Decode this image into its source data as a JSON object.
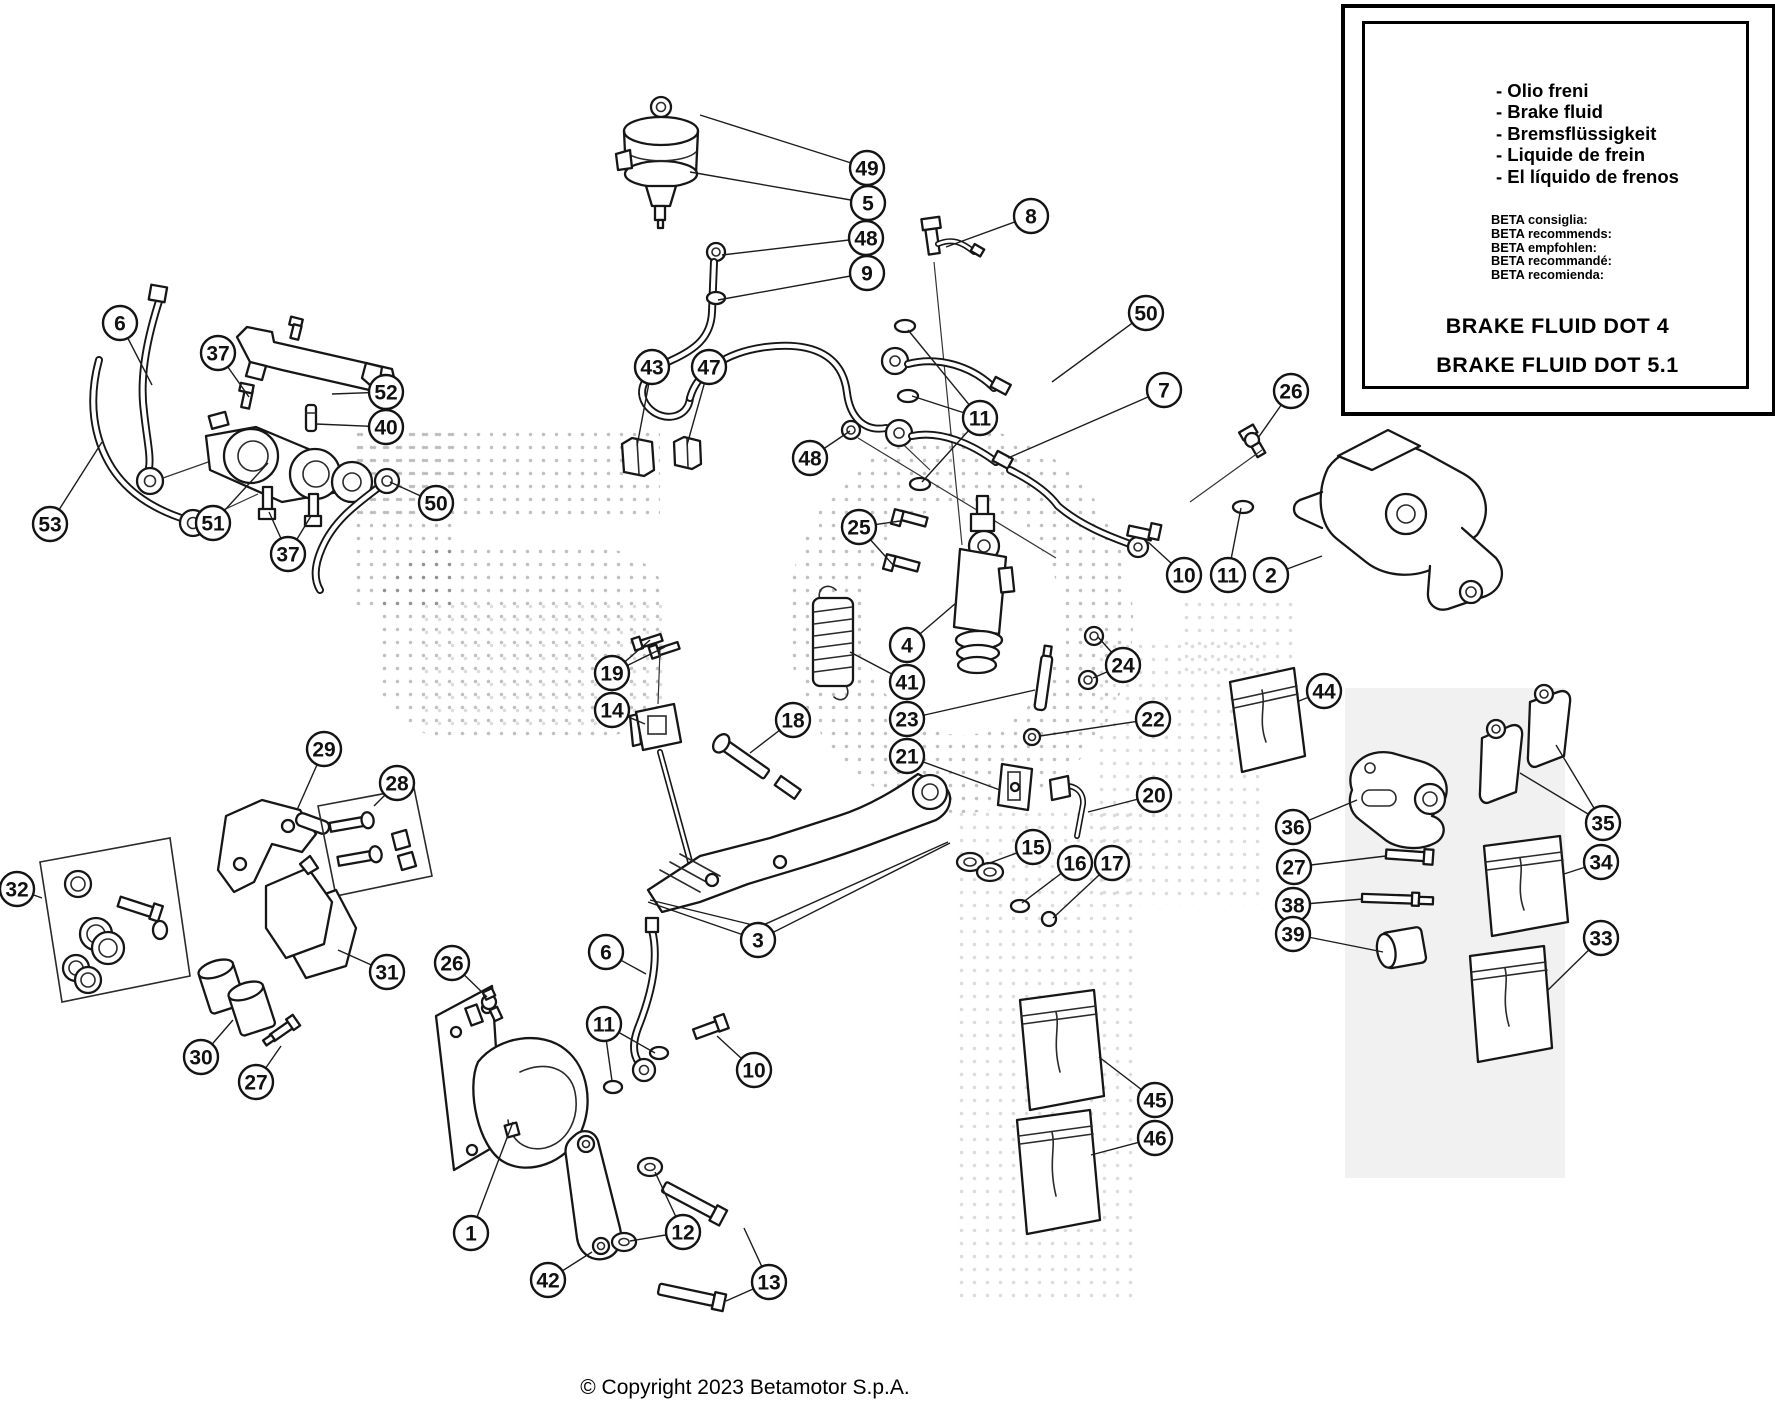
{
  "info_box": {
    "bottle": {
      "line1": "BRAKE",
      "line2": "FLUID"
    },
    "languages": [
      "- Olio freni",
      "- Brake fluid",
      "- Bremsflüssigkeit",
      "- Liquide de frein",
      "- El líquido de frenos"
    ],
    "beta": [
      "BETA consiglia:",
      "BETA recommends:",
      "BETA empfohlen:",
      "BETA recommandé:",
      "BETA recomienda:"
    ],
    "dot4": "BRAKE FLUID DOT 4",
    "dot51": "BRAKE FLUID DOT 5.1"
  },
  "page": {
    "copyright": "© Copyright 2023 Betamotor S.p.A."
  },
  "callouts": [
    {
      "n": "49",
      "x": 867,
      "y": 168,
      "to": [
        [
          700,
          115
        ]
      ]
    },
    {
      "n": "5",
      "x": 868,
      "y": 203,
      "to": [
        [
          690,
          172
        ]
      ]
    },
    {
      "n": "48",
      "x": 866,
      "y": 238,
      "to": [
        [
          722,
          255
        ]
      ]
    },
    {
      "n": "9",
      "x": 867,
      "y": 273,
      "to": [
        [
          718,
          300
        ]
      ]
    },
    {
      "n": "8",
      "x": 1031,
      "y": 216,
      "to": [
        [
          946,
          247
        ]
      ]
    },
    {
      "n": "6",
      "x": 120,
      "y": 323,
      "to": [
        [
          152,
          385
        ]
      ]
    },
    {
      "n": "37",
      "x": 218,
      "y": 353,
      "to": [
        [
          249,
          397
        ]
      ]
    },
    {
      "n": "52",
      "x": 386,
      "y": 392,
      "to": [
        [
          332,
          394
        ]
      ]
    },
    {
      "n": "40",
      "x": 386,
      "y": 427,
      "to": [
        [
          316,
          424
        ]
      ]
    },
    {
      "n": "43",
      "x": 652,
      "y": 367,
      "to": [
        [
          637,
          446
        ]
      ]
    },
    {
      "n": "47",
      "x": 709,
      "y": 367,
      "to": [
        [
          687,
          445
        ]
      ]
    },
    {
      "n": "50",
      "x": 1146,
      "y": 313,
      "to": [
        [
          1052,
          382
        ]
      ]
    },
    {
      "n": "11",
      "x": 980,
      "y": 418,
      "to": [
        [
          908,
          330
        ],
        [
          912,
          396
        ],
        [
          922,
          482
        ]
      ]
    },
    {
      "n": "7",
      "x": 1164,
      "y": 390,
      "to": [
        [
          1008,
          458
        ]
      ]
    },
    {
      "n": "26",
      "x": 1291,
      "y": 391,
      "to": [
        [
          1258,
          438
        ]
      ]
    },
    {
      "n": "53",
      "x": 50,
      "y": 524,
      "to": [
        [
          102,
          442
        ]
      ]
    },
    {
      "n": "51",
      "x": 213,
      "y": 523,
      "to": [
        [
          268,
          463
        ]
      ]
    },
    {
      "n": "37",
      "x": 288,
      "y": 554,
      "to": [
        [
          269,
          512
        ],
        [
          311,
          516
        ]
      ]
    },
    {
      "n": "50",
      "x": 436,
      "y": 503,
      "to": [
        [
          390,
          482
        ]
      ]
    },
    {
      "n": "48",
      "x": 810,
      "y": 458,
      "to": [
        [
          850,
          431
        ]
      ]
    },
    {
      "n": "25",
      "x": 859,
      "y": 527,
      "to": [
        [
          900,
          521
        ],
        [
          894,
          566
        ]
      ]
    },
    {
      "n": "10",
      "x": 1184,
      "y": 575,
      "to": [
        [
          1148,
          542
        ]
      ]
    },
    {
      "n": "11",
      "x": 1228,
      "y": 575,
      "to": [
        [
          1241,
          508
        ]
      ]
    },
    {
      "n": "2",
      "x": 1271,
      "y": 575,
      "to": [
        [
          1322,
          556
        ]
      ]
    },
    {
      "n": "4",
      "x": 907,
      "y": 645,
      "to": [
        [
          956,
          603
        ]
      ]
    },
    {
      "n": "24",
      "x": 1123,
      "y": 665,
      "to": [
        [
          1098,
          637
        ],
        [
          1093,
          678
        ]
      ]
    },
    {
      "n": "41",
      "x": 907,
      "y": 682,
      "to": [
        [
          850,
          652
        ]
      ]
    },
    {
      "n": "19",
      "x": 612,
      "y": 673,
      "to": [
        [
          650,
          640
        ],
        [
          665,
          647
        ]
      ]
    },
    {
      "n": "23",
      "x": 907,
      "y": 719,
      "to": [
        [
          1035,
          690
        ]
      ]
    },
    {
      "n": "22",
      "x": 1153,
      "y": 719,
      "to": [
        [
          1040,
          736
        ]
      ]
    },
    {
      "n": "14",
      "x": 612,
      "y": 710,
      "to": [
        [
          645,
          724
        ]
      ]
    },
    {
      "n": "18",
      "x": 793,
      "y": 720,
      "to": [
        [
          750,
          753
        ]
      ]
    },
    {
      "n": "21",
      "x": 907,
      "y": 756,
      "to": [
        [
          1000,
          790
        ]
      ]
    },
    {
      "n": "20",
      "x": 1154,
      "y": 795,
      "to": [
        [
          1088,
          812
        ]
      ]
    },
    {
      "n": "15",
      "x": 1033,
      "y": 847,
      "to": [
        [
          987,
          864
        ]
      ]
    },
    {
      "n": "16",
      "x": 1075,
      "y": 863,
      "to": [
        [
          1022,
          903
        ]
      ]
    },
    {
      "n": "17",
      "x": 1112,
      "y": 863,
      "to": [
        [
          1053,
          918
        ]
      ]
    },
    {
      "n": "29",
      "x": 324,
      "y": 749,
      "to": [
        [
          297,
          810
        ]
      ]
    },
    {
      "n": "28",
      "x": 397,
      "y": 783,
      "to": [
        [
          374,
          806
        ]
      ]
    },
    {
      "n": "44",
      "x": 1324,
      "y": 691,
      "to": [
        [
          1299,
          701
        ]
      ]
    },
    {
      "n": "36",
      "x": 1293,
      "y": 827,
      "to": [
        [
          1357,
          800
        ]
      ]
    },
    {
      "n": "27",
      "x": 1294,
      "y": 867,
      "to": [
        [
          1386,
          856
        ]
      ]
    },
    {
      "n": "38",
      "x": 1293,
      "y": 905,
      "to": [
        [
          1363,
          899
        ]
      ]
    },
    {
      "n": "39",
      "x": 1293,
      "y": 934,
      "to": [
        [
          1383,
          952
        ]
      ]
    },
    {
      "n": "35",
      "x": 1603,
      "y": 823,
      "to": [
        [
          1520,
          773
        ],
        [
          1556,
          745
        ]
      ]
    },
    {
      "n": "34",
      "x": 1601,
      "y": 862,
      "to": [
        [
          1564,
          874
        ]
      ]
    },
    {
      "n": "33",
      "x": 1601,
      "y": 938,
      "to": [
        [
          1548,
          990
        ]
      ]
    },
    {
      "n": "32",
      "x": 17,
      "y": 889,
      "to": [
        [
          42,
          898
        ]
      ]
    },
    {
      "n": "31",
      "x": 387,
      "y": 972,
      "to": [
        [
          338,
          950
        ]
      ]
    },
    {
      "n": "26",
      "x": 452,
      "y": 963,
      "to": [
        [
          487,
          997
        ]
      ]
    },
    {
      "n": "30",
      "x": 201,
      "y": 1057,
      "to": [
        [
          233,
          1020
        ]
      ]
    },
    {
      "n": "27",
      "x": 256,
      "y": 1082,
      "to": [
        [
          281,
          1046
        ]
      ]
    },
    {
      "n": "3",
      "x": 758,
      "y": 940,
      "to": [
        [
          648,
          902
        ],
        [
          950,
          843
        ]
      ]
    },
    {
      "n": "6",
      "x": 606,
      "y": 952,
      "to": [
        [
          646,
          974
        ]
      ]
    },
    {
      "n": "11",
      "x": 604,
      "y": 1024,
      "to": [
        [
          612,
          1081
        ],
        [
          655,
          1053
        ]
      ]
    },
    {
      "n": "10",
      "x": 754,
      "y": 1070,
      "to": [
        [
          717,
          1036
        ]
      ]
    },
    {
      "n": "45",
      "x": 1155,
      "y": 1100,
      "to": [
        [
          1099,
          1057
        ]
      ]
    },
    {
      "n": "46",
      "x": 1155,
      "y": 1138,
      "to": [
        [
          1091,
          1155
        ]
      ]
    },
    {
      "n": "1",
      "x": 471,
      "y": 1233,
      "to": [
        [
          513,
          1122
        ]
      ]
    },
    {
      "n": "42",
      "x": 548,
      "y": 1280,
      "to": [
        [
          592,
          1252
        ]
      ]
    },
    {
      "n": "12",
      "x": 683,
      "y": 1232,
      "to": [
        [
          655,
          1172
        ],
        [
          630,
          1241
        ]
      ]
    },
    {
      "n": "13",
      "x": 769,
      "y": 1282,
      "to": [
        [
          744,
          1228
        ],
        [
          726,
          1301
        ]
      ]
    }
  ]
}
